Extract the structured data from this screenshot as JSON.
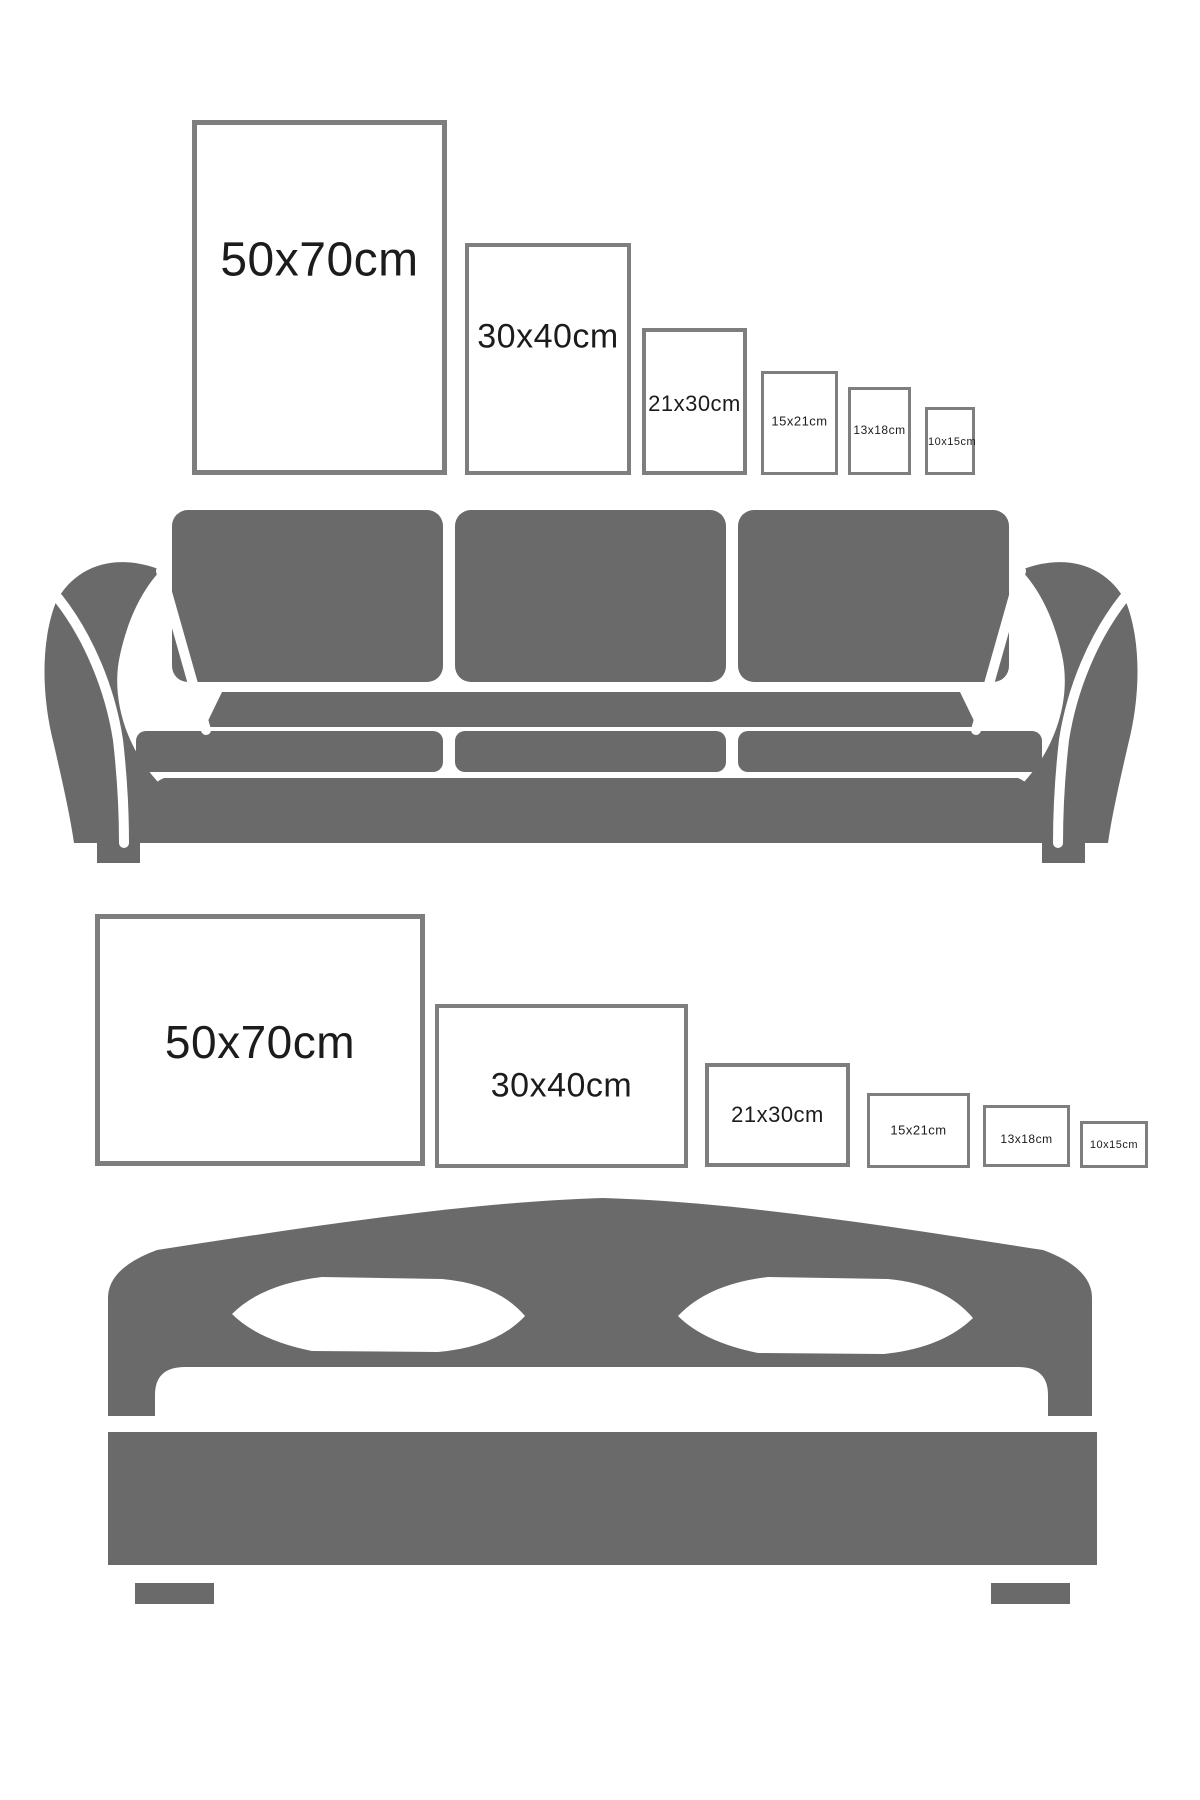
{
  "background": "#ffffff",
  "colors": {
    "furniture": "#6a6a6a",
    "frame_border": "#7e7e7e",
    "label_text": "#1c1c1c",
    "background": "#ffffff"
  },
  "scenes": [
    {
      "name": "portrait-posters-above-sofa",
      "furniture": "sofa",
      "orientation": "portrait",
      "frames": [
        {
          "label": "50x70cm",
          "x": 192,
          "y": 120,
          "width": 255,
          "height": 355,
          "border": 5,
          "font_size": 48,
          "label_pos": 0.39
        },
        {
          "label": "30x40cm",
          "x": 465,
          "y": 243,
          "width": 166,
          "height": 232,
          "border": 4,
          "font_size": 34,
          "label_pos": 0.4
        },
        {
          "label": "21x30cm",
          "x": 642,
          "y": 328,
          "width": 105,
          "height": 147,
          "border": 4,
          "font_size": 22,
          "label_pos": 0.52
        },
        {
          "label": "15x21cm",
          "x": 761,
          "y": 371,
          "width": 77,
          "height": 104,
          "border": 3,
          "font_size": 13,
          "label_pos": 0.48
        },
        {
          "label": "13x18cm",
          "x": 848,
          "y": 387,
          "width": 63,
          "height": 88,
          "border": 3,
          "font_size": 12,
          "label_pos": 0.49
        },
        {
          "label": "10x15cm",
          "x": 925,
          "y": 407,
          "width": 50,
          "height": 68,
          "border": 3,
          "font_size": 11,
          "label_pos": 0.51
        }
      ]
    },
    {
      "name": "landscape-posters-above-bed",
      "furniture": "bed",
      "orientation": "landscape",
      "frames": [
        {
          "label": "50x70cm",
          "x": 95,
          "y": 914,
          "width": 330,
          "height": 252,
          "border": 5,
          "font_size": 46,
          "label_pos": 0.51
        },
        {
          "label": "30x40cm",
          "x": 435,
          "y": 1004,
          "width": 253,
          "height": 164,
          "border": 4,
          "font_size": 34,
          "label_pos": 0.5
        },
        {
          "label": "21x30cm",
          "x": 705,
          "y": 1063,
          "width": 145,
          "height": 104,
          "border": 4,
          "font_size": 22,
          "label_pos": 0.5
        },
        {
          "label": "15x21cm",
          "x": 867,
          "y": 1093,
          "width": 103,
          "height": 75,
          "border": 3,
          "font_size": 13,
          "label_pos": 0.49
        },
        {
          "label": "13x18cm",
          "x": 983,
          "y": 1105,
          "width": 87,
          "height": 62,
          "border": 3,
          "font_size": 12,
          "label_pos": 0.55
        },
        {
          "label": "10x15cm",
          "x": 1080,
          "y": 1121,
          "width": 68,
          "height": 47,
          "border": 3,
          "font_size": 11,
          "label_pos": 0.5
        }
      ]
    }
  ]
}
